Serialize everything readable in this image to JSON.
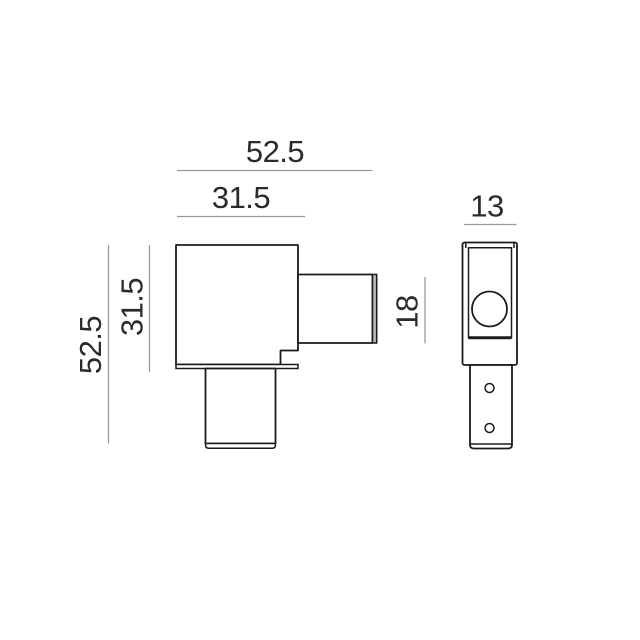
{
  "drawing": {
    "type": "technical-dimension-drawing",
    "background_color": "#ffffff",
    "outline_color": "#1b1b1b",
    "dimension_line_color": "#9b9b9b",
    "text_color": "#2b2b2b",
    "end_cap_fill_color": "#b9b9b9",
    "front_view": {
      "total_width_label": "52.5",
      "body_width_label": "31.5",
      "total_height_label": "52.5",
      "body_height_label": "31.5",
      "stub_height_label": "18"
    },
    "side_view": {
      "width_label": "13"
    }
  }
}
